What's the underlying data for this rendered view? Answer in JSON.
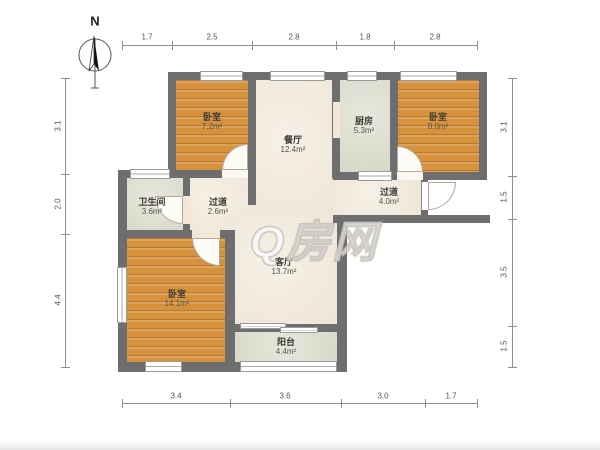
{
  "compass": {
    "label": "N"
  },
  "watermark": {
    "text": "Q房网"
  },
  "rooms": {
    "bedroom_top_left": {
      "name": "卧室",
      "area": "7.2m²"
    },
    "dining": {
      "name": "餐厅",
      "area": "12.4m²"
    },
    "kitchen": {
      "name": "厨房",
      "area": "5.3m²"
    },
    "bedroom_top_right": {
      "name": "卧室",
      "area": "8.0m²"
    },
    "bathroom": {
      "name": "卫生间",
      "area": "3.6m²"
    },
    "hallway_left": {
      "name": "过道",
      "area": "2.6m²"
    },
    "hallway_right": {
      "name": "过道",
      "area": "4.0m²"
    },
    "living": {
      "name": "客厅",
      "area": "13.7m²"
    },
    "bedroom_bottom_left": {
      "name": "卧室",
      "area": "14.1m²"
    },
    "balcony": {
      "name": "阳台",
      "area": "4.4m²"
    }
  },
  "dimensions": {
    "top": [
      "1.7",
      "2.5",
      "2.8",
      "1.8",
      "2.8"
    ],
    "bottom": [
      "3.4",
      "3.6",
      "3.0",
      "1.7"
    ],
    "left": [
      "3.1",
      "2.0",
      "4.4"
    ],
    "right": [
      "3.1",
      "1.5",
      "3.5",
      "1.5"
    ]
  },
  "colors": {
    "wall": "#6e6e6e",
    "bedroom_floor": "#d6913d",
    "common_floor": "#f1e8d9",
    "service_floor": "#dcdccc"
  }
}
